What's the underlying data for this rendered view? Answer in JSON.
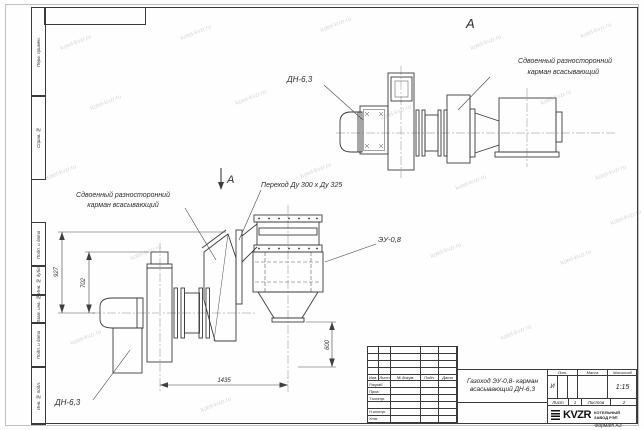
{
  "watermark": "kotel-kvzr.ru",
  "frame": {
    "left_labels": [
      "Перв. примен.",
      "Справ. №",
      "Подп. и дата",
      "Инв. № дубл.",
      "Взам. инв. №",
      "Подп. и дата",
      "Инв. № подл."
    ],
    "format_note": "Формат А3"
  },
  "views": {
    "view_a_label": "А",
    "section_arrow_label": "А",
    "pocket_label": {
      "line1": "Сдвоенный разносторонний",
      "line2": "карман всасывающий"
    },
    "fan_label": "ДН-6,3",
    "transition_label": "Переход Ду  300 х  Ду 325",
    "unit_label": "ЭУ-0,8",
    "dimensions": {
      "d927": "927",
      "d702": "702",
      "d600": "600",
      "d1435": "1435"
    }
  },
  "title_block": {
    "revision_headers": [
      "Изм.",
      "Лист",
      "№ докум.",
      "Подп.",
      "Дата"
    ],
    "role_rows": [
      "Разраб.",
      "Пров.",
      "Т.контр.",
      "",
      "Н.контр.",
      "Утв."
    ],
    "doc_title_line1": "Газоход ЭУ-0,8- карман",
    "doc_title_line2": "всасывающий ДН-6,3",
    "lit_header": "Лит.",
    "mass_header": "Масса",
    "scale_header": "Масштаб",
    "lit_value": "И",
    "scale_value": "1:15",
    "sheet_label": "Лист",
    "sheet_value": "1",
    "sheets_label": "Листов",
    "sheets_value": "2",
    "company_logo": "KVZR",
    "company_name_line1": "КОТЕЛЬНЫЙ",
    "company_name_line2": "ЗАВОД РЭП"
  }
}
